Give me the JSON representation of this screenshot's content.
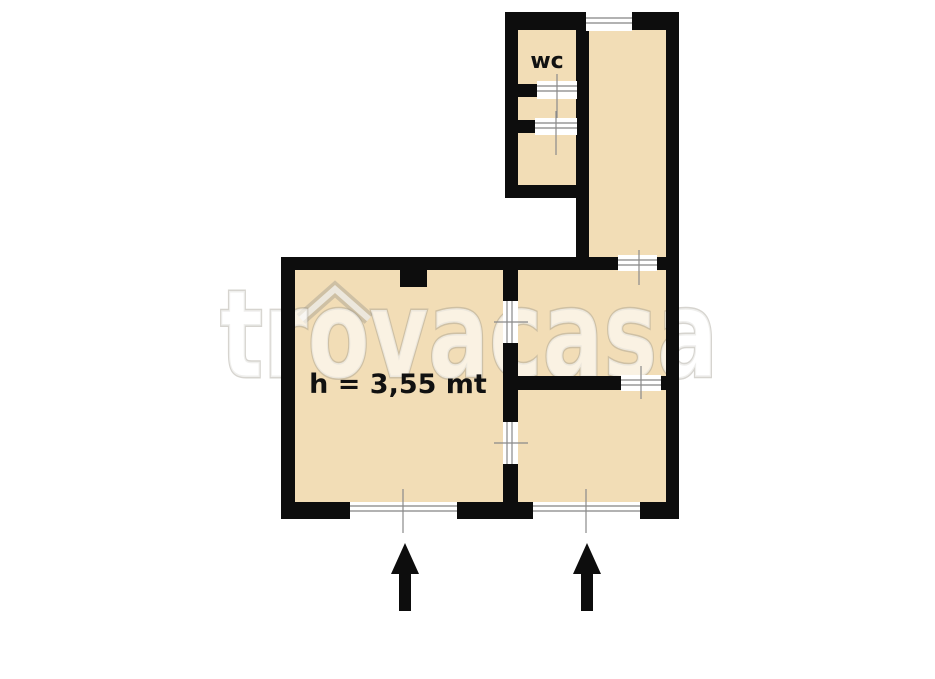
{
  "page": {
    "type": "floor-plan",
    "source_watermark": "trovacasa"
  },
  "labels": {
    "wc_room": "wc",
    "ceiling_height": "h = 3,55 mt"
  },
  "watermark": {
    "text": "trovacasa",
    "logo": "house-roof-over-o"
  },
  "icons": {
    "entrance_arrow_left": "up-arrow",
    "entrance_arrow_right": "up-arrow",
    "roof_icon": "chevron-roof"
  },
  "colors": {
    "background": "#ffffff",
    "room_fill": "#f2ddb6",
    "wall": "#0d0d0d",
    "opening_fill": "#ffffff",
    "opening_line": "#999999",
    "tick_line": "#8a8a8a",
    "label_text": "#111111",
    "arrow": "#0d0d0d",
    "watermark_fill": "rgba(255,255,255,0.62)",
    "watermark_outline": "rgba(158,152,140,0.42)"
  }
}
